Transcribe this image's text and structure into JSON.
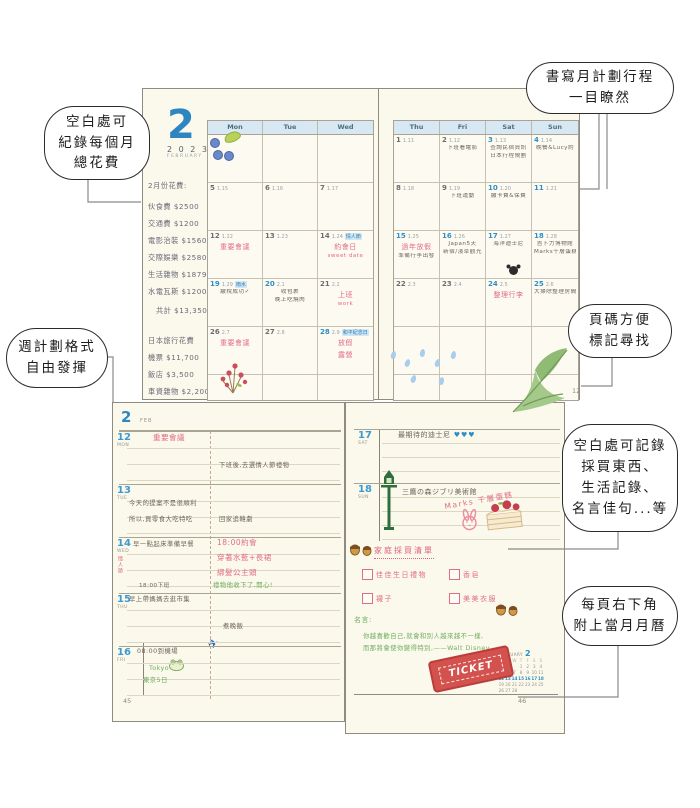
{
  "callouts": [
    {
      "id": "expense",
      "lines": [
        "空白處可",
        "紀錄每個月",
        "總花費"
      ]
    },
    {
      "id": "monthly-plan",
      "lines": [
        "書寫月計劃行程",
        "一目瞭然"
      ]
    },
    {
      "id": "page-number",
      "lines": [
        "頁碼方便",
        "標記尋找"
      ]
    },
    {
      "id": "weekly-format",
      "lines": [
        "週計劃格式",
        "自由發揮"
      ]
    },
    {
      "id": "blank-space",
      "lines": [
        "空白處可記錄",
        "採買東西、",
        "生活記錄、",
        "名言佳句...等"
      ]
    },
    {
      "id": "mini-calendar",
      "lines": [
        "每頁右下角",
        "附上當月月曆"
      ]
    }
  ],
  "monthly": {
    "month_number": "2",
    "year": "2 0 2 3",
    "month_name": "FEBRUARY",
    "expenses": {
      "title": "2月份花費:",
      "items": [
        "伙食費 $2500",
        "交通費 $1200",
        "電影治裝 $1560",
        "交際娛樂 $2580",
        "生活雜物 $1879",
        "水電瓦斯 $1200"
      ],
      "total": "共計 $13,350",
      "trip_title": "日本旅行花費",
      "trip_items": [
        "機票 $11,700",
        "飯店 $3,500",
        "車資雜物 $2,200"
      ]
    },
    "left": {
      "weekdays": [
        "Mon",
        "Tue",
        "Wed"
      ],
      "rows": [
        [
          {},
          {},
          {}
        ],
        [
          {
            "d": "5",
            "l": "1.15"
          },
          {
            "d": "6",
            "l": "1.16"
          },
          {
            "d": "7",
            "l": "1.17"
          }
        ],
        [
          {
            "d": "12",
            "l": "1.22",
            "n": [
              [
                "重要會議",
                "pink",
                "b"
              ]
            ]
          },
          {
            "d": "13",
            "l": "1.23"
          },
          {
            "d": "14",
            "l": "1.24",
            "tag": "情人節",
            "n": [
              [
                "約會日",
                "pink",
                "b"
              ],
              [
                "sweet date",
                "pink",
                "s"
              ]
            ]
          }
        ],
        [
          {
            "d": "19",
            "l": "1.29",
            "b": true,
            "tag": "雨水",
            "n": [
              [
                "繳稅成功✓",
                "ink",
                "s"
              ]
            ]
          },
          {
            "d": "20",
            "l": "2.1",
            "b": true,
            "n": [
              [
                "收包裹",
                "ink",
                "s"
              ],
              [
                "晚上吃燒肉",
                "ink",
                "s"
              ]
            ]
          },
          {
            "d": "21",
            "l": "2.2",
            "n": [
              [
                "上班",
                "pink",
                "b"
              ],
              [
                "work",
                "pink",
                "s"
              ]
            ]
          }
        ],
        [
          {
            "d": "26",
            "l": "2.7",
            "n": [
              [
                "重要會議",
                "pink",
                "b"
              ]
            ]
          },
          {
            "d": "27",
            "l": "2.8"
          },
          {
            "d": "28",
            "l": "2.9",
            "b": true,
            "tag": "和平紀念日",
            "n": [
              [
                "放假",
                "pink",
                "b"
              ],
              [
                "露營",
                "pink",
                "b"
              ]
            ]
          }
        ]
      ]
    },
    "right": {
      "weekdays": [
        "Thu",
        "Fri",
        "Sat",
        "Sun"
      ],
      "rows": [
        [
          {
            "d": "1",
            "l": "1.11"
          },
          {
            "d": "2",
            "l": "1.12",
            "n": [
              [
                "下班看電影",
                "ink",
                "s"
              ]
            ]
          },
          {
            "d": "3",
            "l": "1.13",
            "b": true,
            "n": [
              [
                "查詢民宿資訊",
                "ink",
                "s"
              ],
              [
                "日本行程規劃",
                "ink",
                "s"
              ]
            ]
          },
          {
            "d": "4",
            "l": "1.14",
            "b": true,
            "n": [
              [
                "晚餐&Lucy約",
                "ink",
                "s"
              ]
            ]
          }
        ],
        [
          {
            "d": "8",
            "l": "1.18"
          },
          {
            "d": "9",
            "l": "1.19",
            "n": [
              [
                "下班運動",
                "ink",
                "s"
              ]
            ]
          },
          {
            "d": "10",
            "l": "1.20",
            "b": true,
            "n": [
              [
                "繳卡費&保費",
                "ink",
                "s"
              ]
            ]
          },
          {
            "d": "11",
            "l": "1.21",
            "b": true
          }
        ],
        [
          {
            "d": "15",
            "l": "1.25",
            "b": true,
            "n": [
              [
                "過年放假",
                "pink",
                "b"
              ],
              [
                "準備行李出發",
                "ink",
                "s"
              ]
            ]
          },
          {
            "d": "16",
            "l": "1.26",
            "b": true,
            "n": [
              [
                "Japan5天",
                "ink",
                "s"
              ],
              [
                "新宿/淺草觀光",
                "ink",
                "s"
              ]
            ]
          },
          {
            "d": "17",
            "l": "1.27",
            "b": true,
            "n": [
              [
                "海洋迪士尼",
                "ink",
                "s"
              ]
            ],
            "mickey": true
          },
          {
            "d": "18",
            "l": "1.28",
            "b": true,
            "n": [
              [
                "吉卜力博物館",
                "ink",
                "s"
              ],
              [
                "Marks千層蛋糕",
                "ink",
                "s"
              ]
            ]
          }
        ],
        [
          {
            "d": "22",
            "l": "2.3"
          },
          {
            "d": "23",
            "l": "2.4"
          },
          {
            "d": "24",
            "l": "2.5",
            "b": true,
            "n": [
              [
                "整理行李",
                "pink",
                "b"
              ]
            ]
          },
          {
            "d": "25",
            "l": "2.6",
            "b": true,
            "n": [
              [
                "大掃除整理房間",
                "ink",
                "s"
              ]
            ]
          }
        ],
        [
          {},
          {},
          {},
          {}
        ]
      ],
      "page_number": "12"
    }
  },
  "weekly": {
    "left": {
      "month_number": "2",
      "month_abbr": "FEB",
      "days": [
        {
          "date": "12",
          "dow": "MON",
          "left": [
            "重要會議"
          ],
          "right": [
            "下班後,去選情人節禮物"
          ]
        },
        {
          "date": "13",
          "dow": "TUE",
          "left": [
            "今天的提案不是很順利",
            "所以,買零食大吃特吃"
          ],
          "right": [
            "回家追韓劇"
          ]
        },
        {
          "date": "14",
          "dow": "WED",
          "side_tag": "情人節",
          "left": [
            "早一點起床準備早餐",
            "18:00下班"
          ],
          "right": [
            "18:00約會",
            "穿著水藍+長裙",
            "綁髮公主頭",
            "禮物他收下了,開心!"
          ]
        },
        {
          "date": "15",
          "dow": "THU",
          "left": [
            "早上帶媽媽去逛市集"
          ],
          "right": [
            "煮晚飯"
          ]
        },
        {
          "date": "16",
          "dow": "FRI",
          "left": [
            "08:00到機場",
            "Tokyo",
            "東京5日"
          ],
          "right": []
        }
      ],
      "page_number": "45"
    },
    "right": {
      "days": [
        {
          "date": "17",
          "dow": "SAT",
          "note": "最期待的迪士尼",
          "hearts": "♥♥♥"
        },
        {
          "date": "18",
          "dow": "SUN",
          "note": "三鷹の森ジブリ美術館",
          "diagonal_note": "Marks 千層蛋糕"
        }
      ],
      "shopping": {
        "title": "家庭採買清單",
        "items": [
          "佳佳生日禮物",
          "香皂",
          "襪子",
          "美美衣服"
        ]
      },
      "quote": {
        "label": "名言:",
        "lines": [
          "你越喜歡自己,就會和別人越來越不一樣,",
          "而那將會使你變得特別,——Walt Disney。"
        ]
      },
      "ticket_label": "TICKET",
      "mini_calendar": {
        "title": "FEBRUARY",
        "month_number": "2",
        "dow": [
          "M",
          "T",
          "W",
          "T",
          "F",
          "S",
          "S"
        ],
        "weeks": [
          [
            "",
            "",
            "",
            "1",
            "2",
            "3",
            "4"
          ],
          [
            "5",
            "6",
            "7",
            "8",
            "9",
            "10",
            "11"
          ],
          [
            "12",
            "13",
            "14",
            "15",
            "16",
            "17",
            "18"
          ],
          [
            "19",
            "20",
            "21",
            "22",
            "23",
            "24",
            "25"
          ],
          [
            "26",
            "27",
            "28",
            "",
            "",
            "",
            ""
          ]
        ],
        "highlight_week_index": 2
      },
      "page_number": "46"
    }
  }
}
